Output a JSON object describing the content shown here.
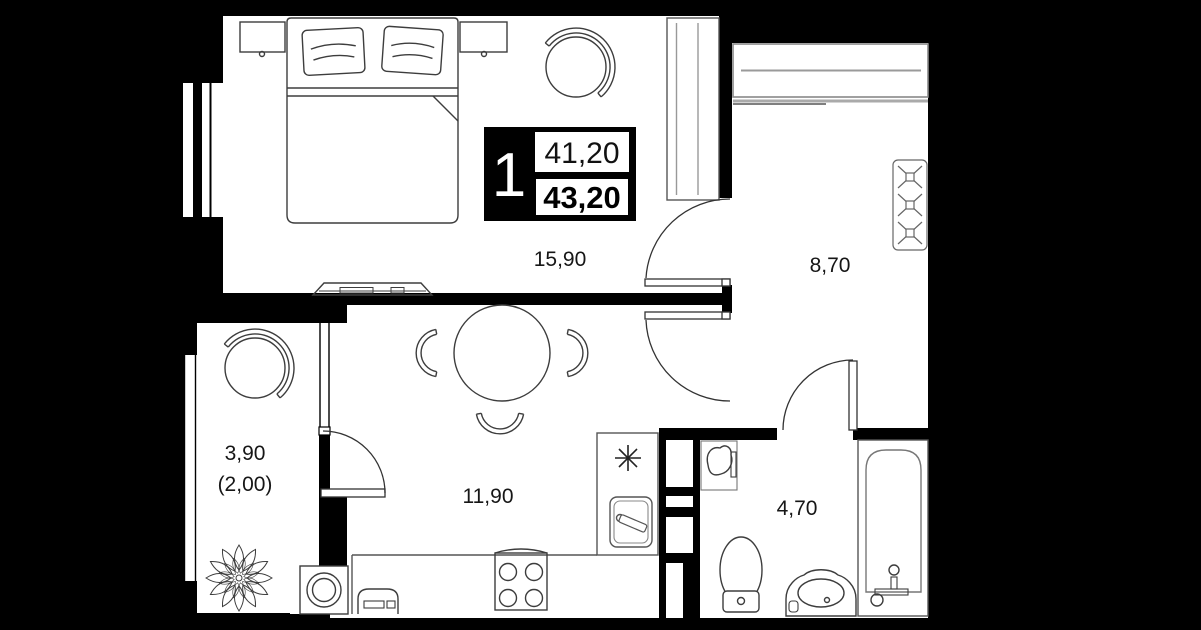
{
  "plan": {
    "unit_badge": {
      "rooms_count": "1",
      "living_area": "41,20",
      "total_area": "43,20"
    },
    "rooms": {
      "bedroom": {
        "label": "15,90"
      },
      "hall": {
        "label": "8,70"
      },
      "living": {
        "label": "11,90"
      },
      "bathroom": {
        "label": "4,70"
      },
      "balcony": {
        "label": "3,90",
        "label_secondary": "(2,00)"
      }
    },
    "colors": {
      "background": "#000000",
      "floor": "#ffffff",
      "wall": "#000000",
      "furniture_line": "#3d3d3d",
      "closet_line": "#999999"
    },
    "icons": [
      "double-bed-icon",
      "pillow-icon",
      "nightstand-icon",
      "round-chair-icon",
      "wardrobe-icon",
      "sliding-closet-icon",
      "coat-wardrobe-x-icon",
      "dining-table-icon",
      "chair-arc-icon",
      "hob-asterisk-icon",
      "kitchen-sink-icon",
      "stove-4-burner-icon",
      "bread-box-icon",
      "washing-machine-icon",
      "plant-icon",
      "vent-shaft-icon",
      "toilet-icon",
      "corner-sink-icon",
      "vanity-basin-icon",
      "bathtub-icon",
      "door-swing-icon",
      "window-icon",
      "tv-stand-icon"
    ]
  }
}
